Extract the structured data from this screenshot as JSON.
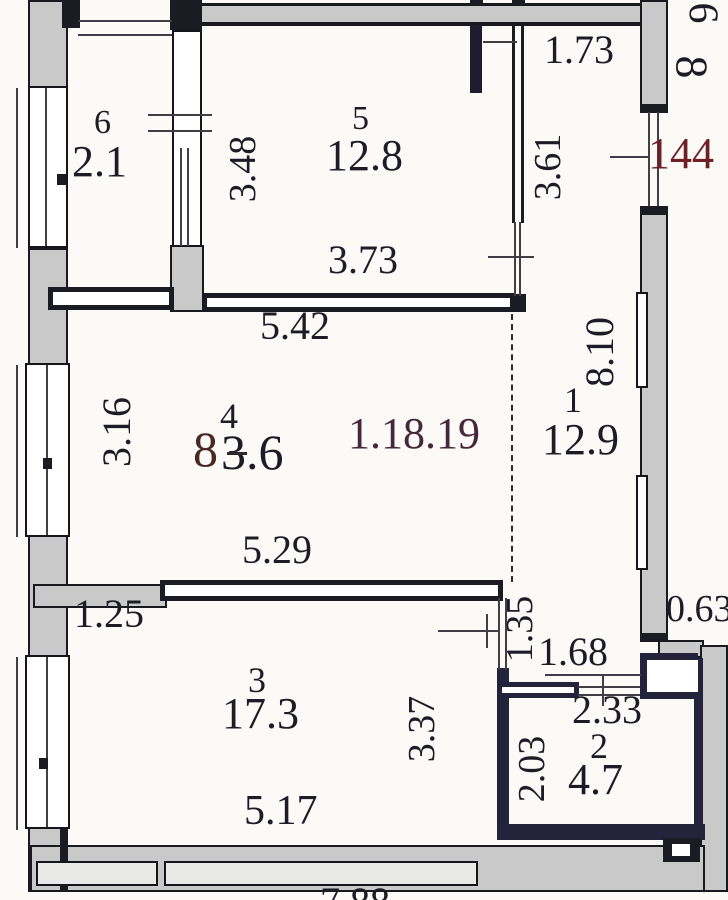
{
  "title": "apartment floor plan",
  "stamps": {
    "apartment_number": "144",
    "date_mark": "1.18.19",
    "corner_top": "6",
    "corner_bottom": "8",
    "area_overlay": "8"
  },
  "rooms": [
    {
      "number": "1",
      "area": "12.9"
    },
    {
      "number": "2",
      "area": "4.7"
    },
    {
      "number": "3",
      "area": "17.3"
    },
    {
      "number": "4",
      "area": "3.6"
    },
    {
      "number": "5",
      "area": "12.8"
    },
    {
      "number": "6",
      "area": "2.1"
    }
  ],
  "dimensions": {
    "top_entry_width": "1.73",
    "room6_wall": "3.48",
    "corridor_length": "3.61",
    "room5_width": "3.73",
    "hall_width": "5.42",
    "right_wall_length": "8.10",
    "hall_window": "3.16",
    "room3_top_width": "5.29",
    "left_stub": "1.25",
    "passage_length": "1.35",
    "niche_width": "1.68",
    "room2_width": "2.33",
    "room2_depth": "2.03",
    "room3_right_wall": "3.37",
    "room3_bottom_width": "5.17",
    "right_step": "0.63",
    "bottom_partial": "7.88"
  },
  "colors": {
    "wall": "#1b1b24",
    "outer_fill": "#c9c9c9",
    "accent_red": "#6e2026",
    "stamp": "#45283a",
    "background": "#fbfaf7"
  }
}
